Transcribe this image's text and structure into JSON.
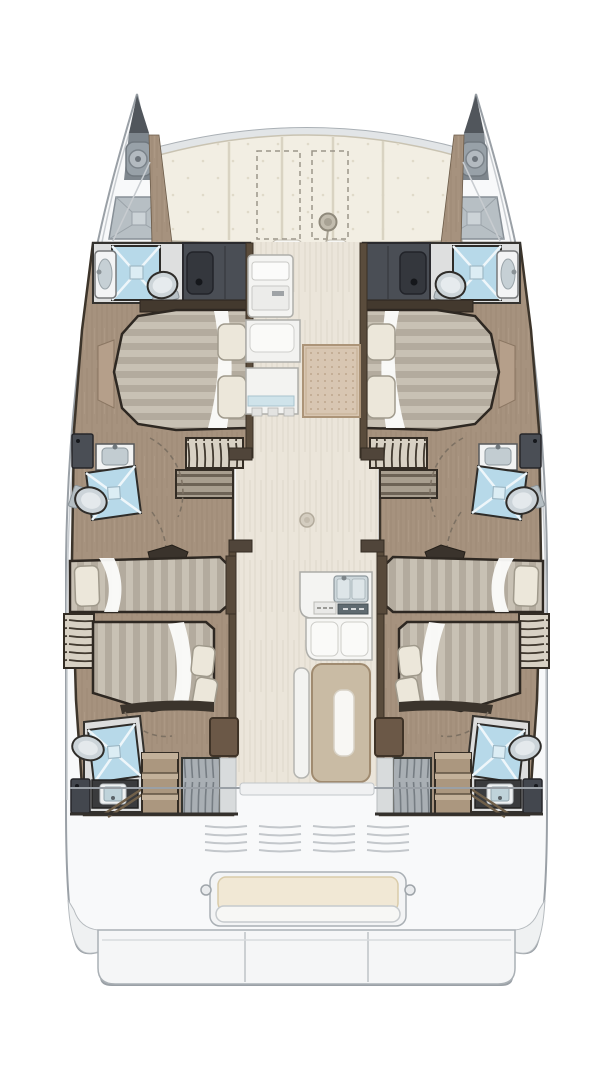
{
  "diagram": {
    "kind": "catamaran-floor-plan",
    "orientation": "bow-up",
    "hull_count": 2
  },
  "foredeck": {
    "sunpad_segments": 5,
    "dashed_deck_hatches": 2,
    "winches": 1
  },
  "port_hull": {
    "bow": {
      "anchor_locker": 1,
      "windlass": 1,
      "deck_hatch": 1
    },
    "bathrooms": 3,
    "bathroom_fixtures_each": [
      "shower",
      "toilet",
      "sink"
    ],
    "wardrobes": 3,
    "beds": {
      "forward_double": 1,
      "aft_berths": 2
    },
    "ladders": 2,
    "drawer_units": 2,
    "hanging_locker": 1,
    "step_chest": 1
  },
  "starboard_hull": {
    "mirror_of": "port_hull"
  },
  "salon": {
    "galley_units": 3,
    "rug": 1,
    "double_sink": 1,
    "stove_strip": 1,
    "settee": 1,
    "dining_table": 1,
    "bench_seat": 1,
    "floor_hatch_dot": 1
  },
  "cockpit": {
    "aft_bench": 1,
    "bench_pins": 2,
    "vent_line_groups": 4,
    "vent_lines_per_group": 4,
    "transom_steps": 3
  },
  "colors": {
    "background": "#ffffff",
    "boat_shell": "#f8f9fa",
    "outline_grey": "#9aa0a6",
    "beam_band": "#e2e5e7",
    "sunpad_cream": "#f2eee3",
    "sunpad_seam": "#d9d3c2",
    "wood_floor": "#a6927e",
    "salon_floor": "#ebe5da",
    "wall_dark": "#33302c",
    "inner_wall_wood": "#5a4c3c",
    "wardrobe_grey": "#4a4e55",
    "wardrobe_door": "#34373d",
    "shower_blue": "#b7d9e9",
    "shower_cross": "#eef6fa",
    "fixture_white": "#f2f3f4",
    "basin_grey": "#c6d0d5",
    "toilet_grey": "#ccd4d9",
    "duvet_light": "#c8c1b4",
    "duvet_dark": "#b3ab9e",
    "sheet_white": "#fcfcfb",
    "pillow_cream": "#ece7da",
    "ladder_bg": "#d8d1c4",
    "ladder_rung": "#423a30",
    "drawer_face": "#a89e8f",
    "drawer_line": "#6d6356",
    "rug_tan": "#d8c6b2",
    "rug_border": "#ac9478",
    "galley_white": "#f4f4f2",
    "sink_steel": "#cdd7db",
    "stove_dark": "#5f6a70",
    "table_beige": "#c9bba4",
    "table_insert": "#f8f7f4",
    "cabinet_brown": "#6b5847",
    "hanging_locker_grey": "#a9afb4",
    "step_chest_wood": "#ab977f",
    "cockpit_bench_cushion": "#f1e8d5",
    "platform_white": "#f5f6f7",
    "vent_line": "#c3c7cb"
  }
}
